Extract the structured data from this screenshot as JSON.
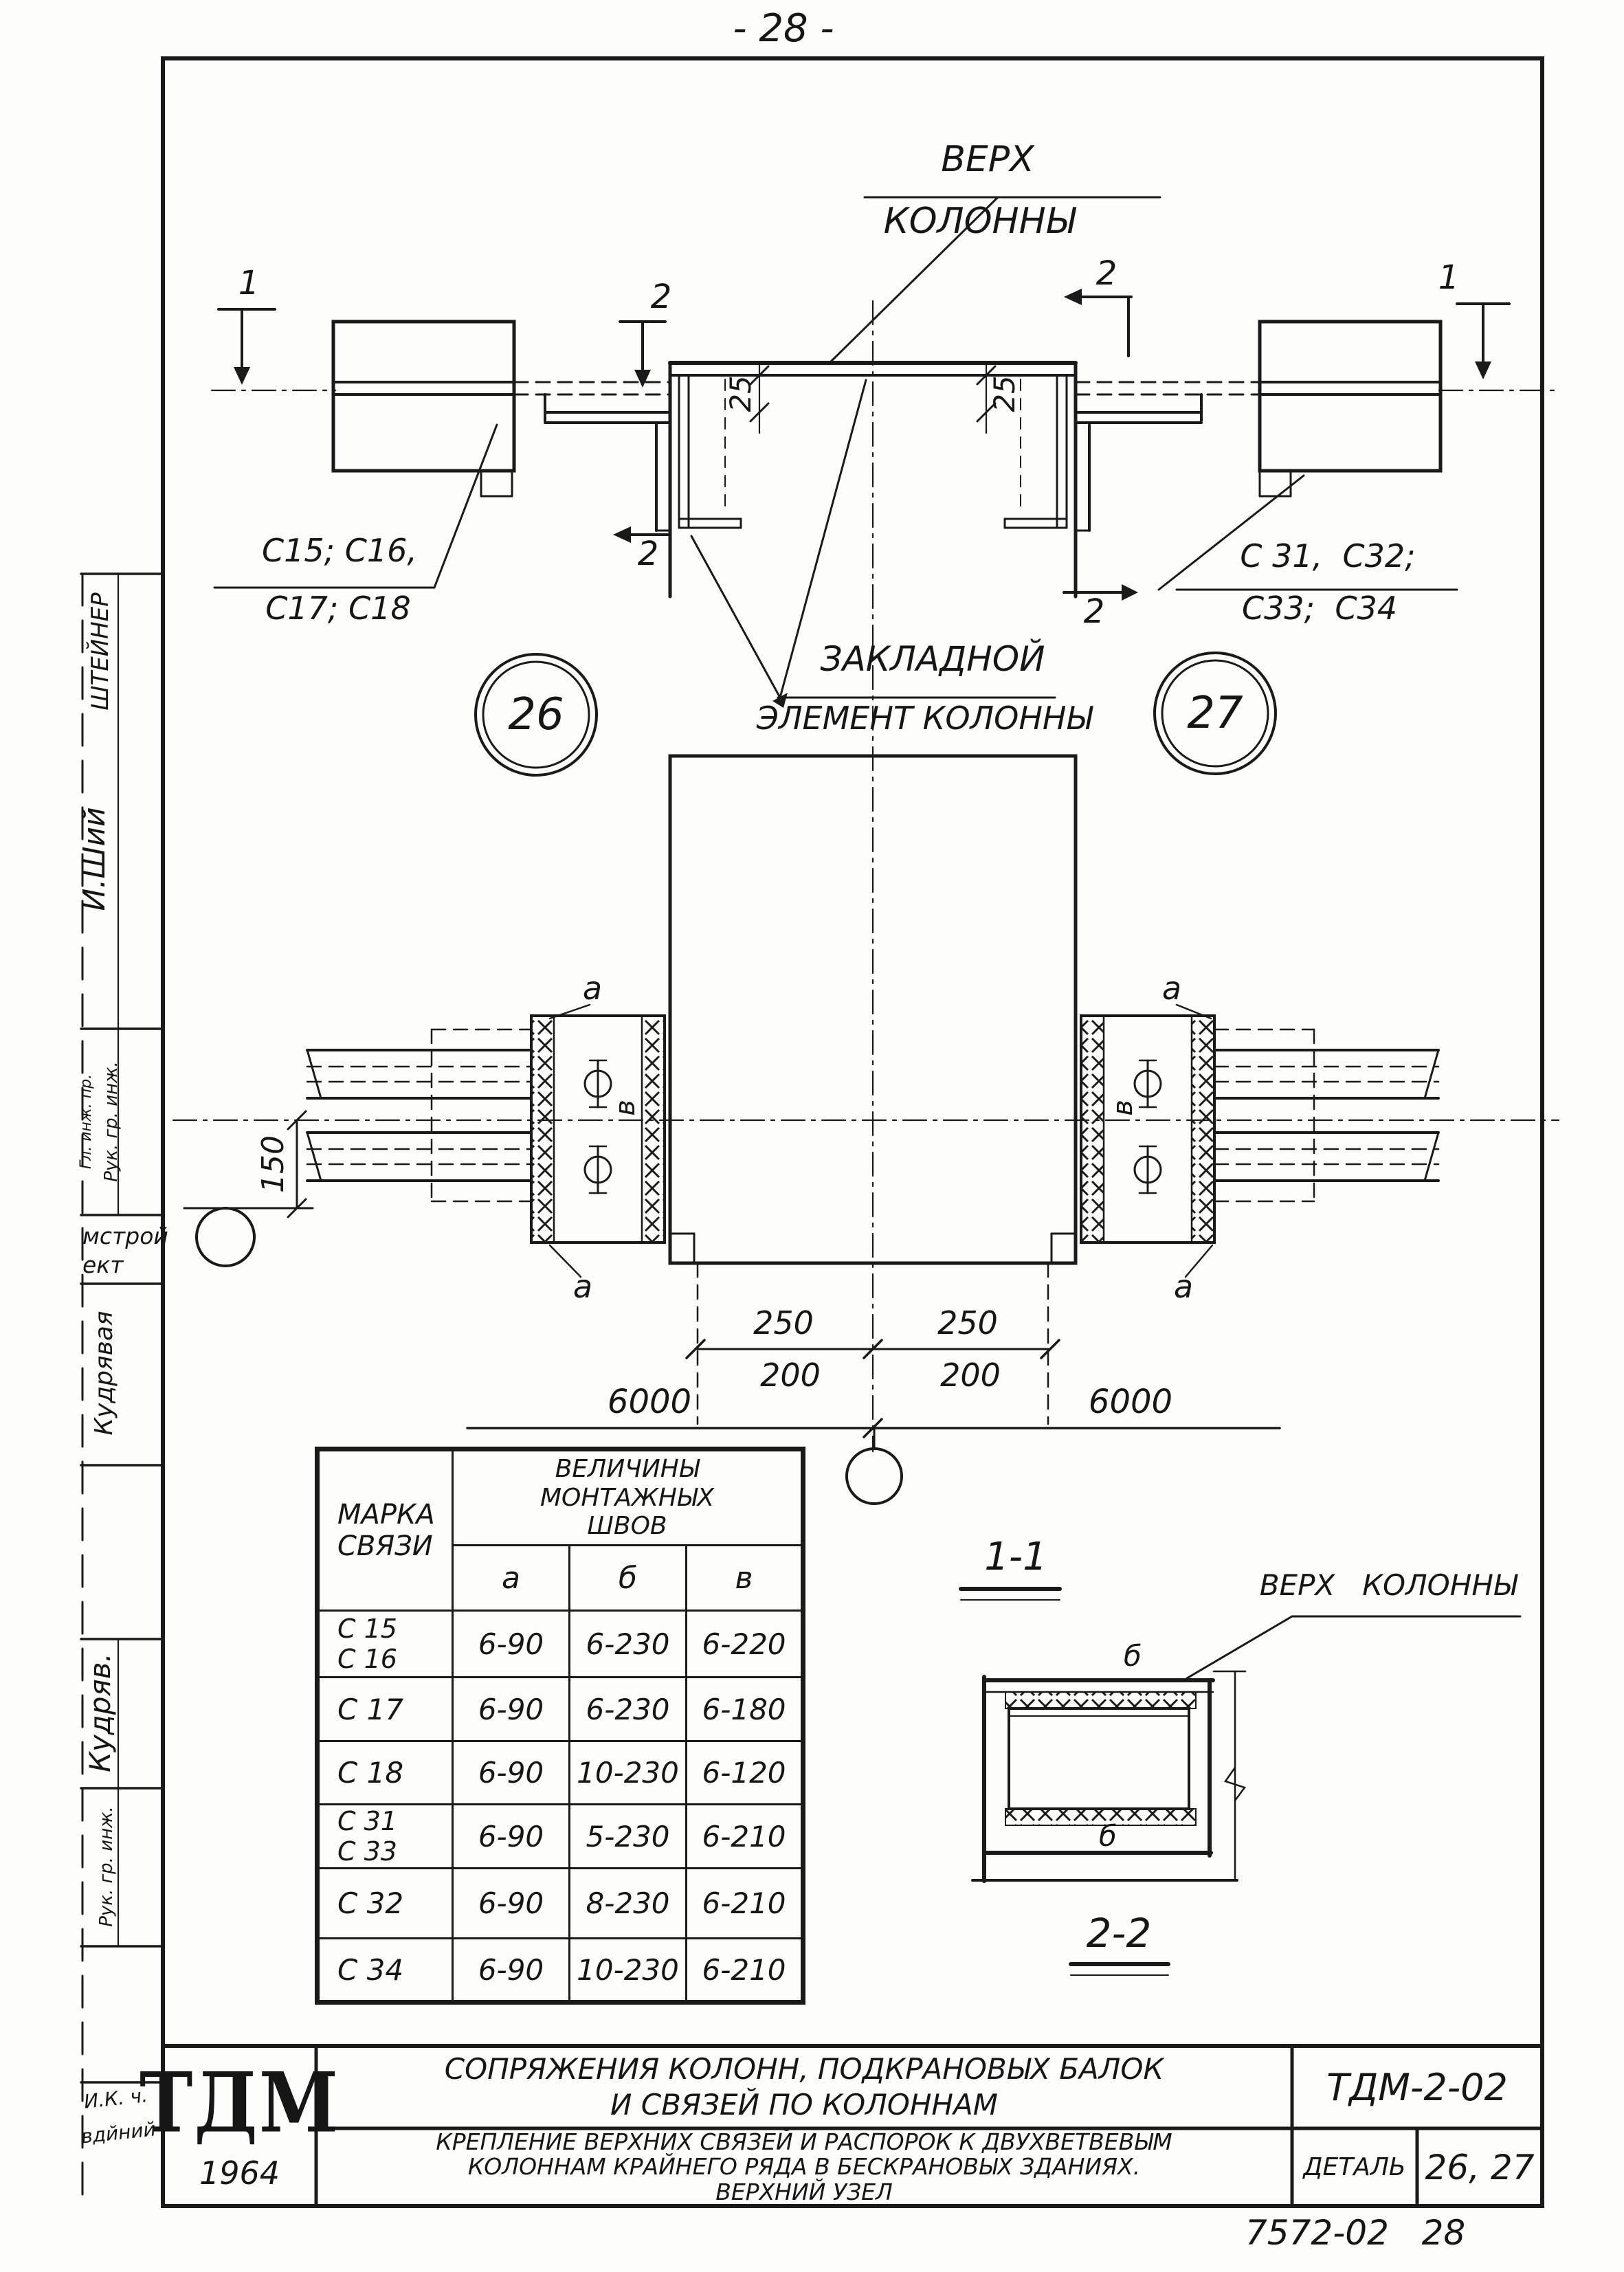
{
  "page": {
    "number": "- 28 -",
    "stamp": "7572-02   28"
  },
  "margin": {
    "name_top": "ШТЕЙНЕР",
    "signature_top": "И.Ший",
    "role_a": "Гл. инж. пр.",
    "role_b": "Рук. гр. инж.",
    "stamp_line_1": "мстрой",
    "stamp_line_2": "ект",
    "name_mid": "Кудрявая",
    "signature_mid": "Кудряв.",
    "role_c": "Рук. гр. инж.",
    "note_line_1": "И.К. ч.",
    "note_line_2": "вдйний"
  },
  "top_view": {
    "top_label_line1": "Верх",
    "top_label_line2": "колонны",
    "embed_label_line1": "Закладной",
    "embed_label_line2": "элемент колонны",
    "left_marks_line1": "C15; C16,",
    "left_marks_line2": "C17; C18",
    "right_marks_line1": "C 31,  C32;",
    "right_marks_line2": "C33;  C34",
    "detail_left": "26",
    "detail_right": "27",
    "dim_25": "25",
    "section_mark_1": "1",
    "section_mark_2": "2"
  },
  "plan_view": {
    "dim_150": "150",
    "dim_250": "250",
    "dim_200": "200",
    "dim_6000": "6000",
    "weld_a": "а",
    "weld_b": "б",
    "weld_v": "в"
  },
  "sections": {
    "section_1_1": "1-1",
    "section_2_2": "2-2",
    "top_label": "Верх   колонны"
  },
  "table": {
    "header_mark_line1": "Марка",
    "header_mark_line2": "связи",
    "header_values_line1": "Величины",
    "header_values_line2": "монтажных",
    "header_values_line3": "швов",
    "col_a": "а",
    "col_b": "б",
    "col_v": "в",
    "rows": [
      {
        "mark1": "C 15",
        "mark2": "C 16",
        "a": "6-90",
        "b": "6-230",
        "v": "6-220"
      },
      {
        "mark1": "C 17",
        "mark2": "",
        "a": "6-90",
        "b": "6-230",
        "v": "6-180"
      },
      {
        "mark1": "C 18",
        "mark2": "",
        "a": "6-90",
        "b": "10-230",
        "v": "6-120"
      },
      {
        "mark1": "C 31",
        "mark2": "C 33",
        "a": "6-90",
        "b": "5-230",
        "v": "6-210"
      },
      {
        "mark1": "C 32",
        "mark2": "",
        "a": "6-90",
        "b": "8-230",
        "v": "6-210"
      },
      {
        "mark1": "C 34",
        "mark2": "",
        "a": "6-90",
        "b": "10-230",
        "v": "6-210"
      }
    ]
  },
  "title_block": {
    "logo": "ТДМ",
    "year": "1964",
    "series_title_line1": "Сопряжения колонн, подкрановых балок",
    "series_title_line2": "и связей по колоннам",
    "code": "ТДМ-2-02",
    "sheet_title_line1": "Крепление верхних связей и распорок к двухветвевым",
    "sheet_title_line2": "колоннам крайнего ряда в бескрановых зданиях.",
    "sheet_title_line3": "Верхний узел",
    "detail_label": "Деталь",
    "detail_numbers": "26, 27"
  }
}
